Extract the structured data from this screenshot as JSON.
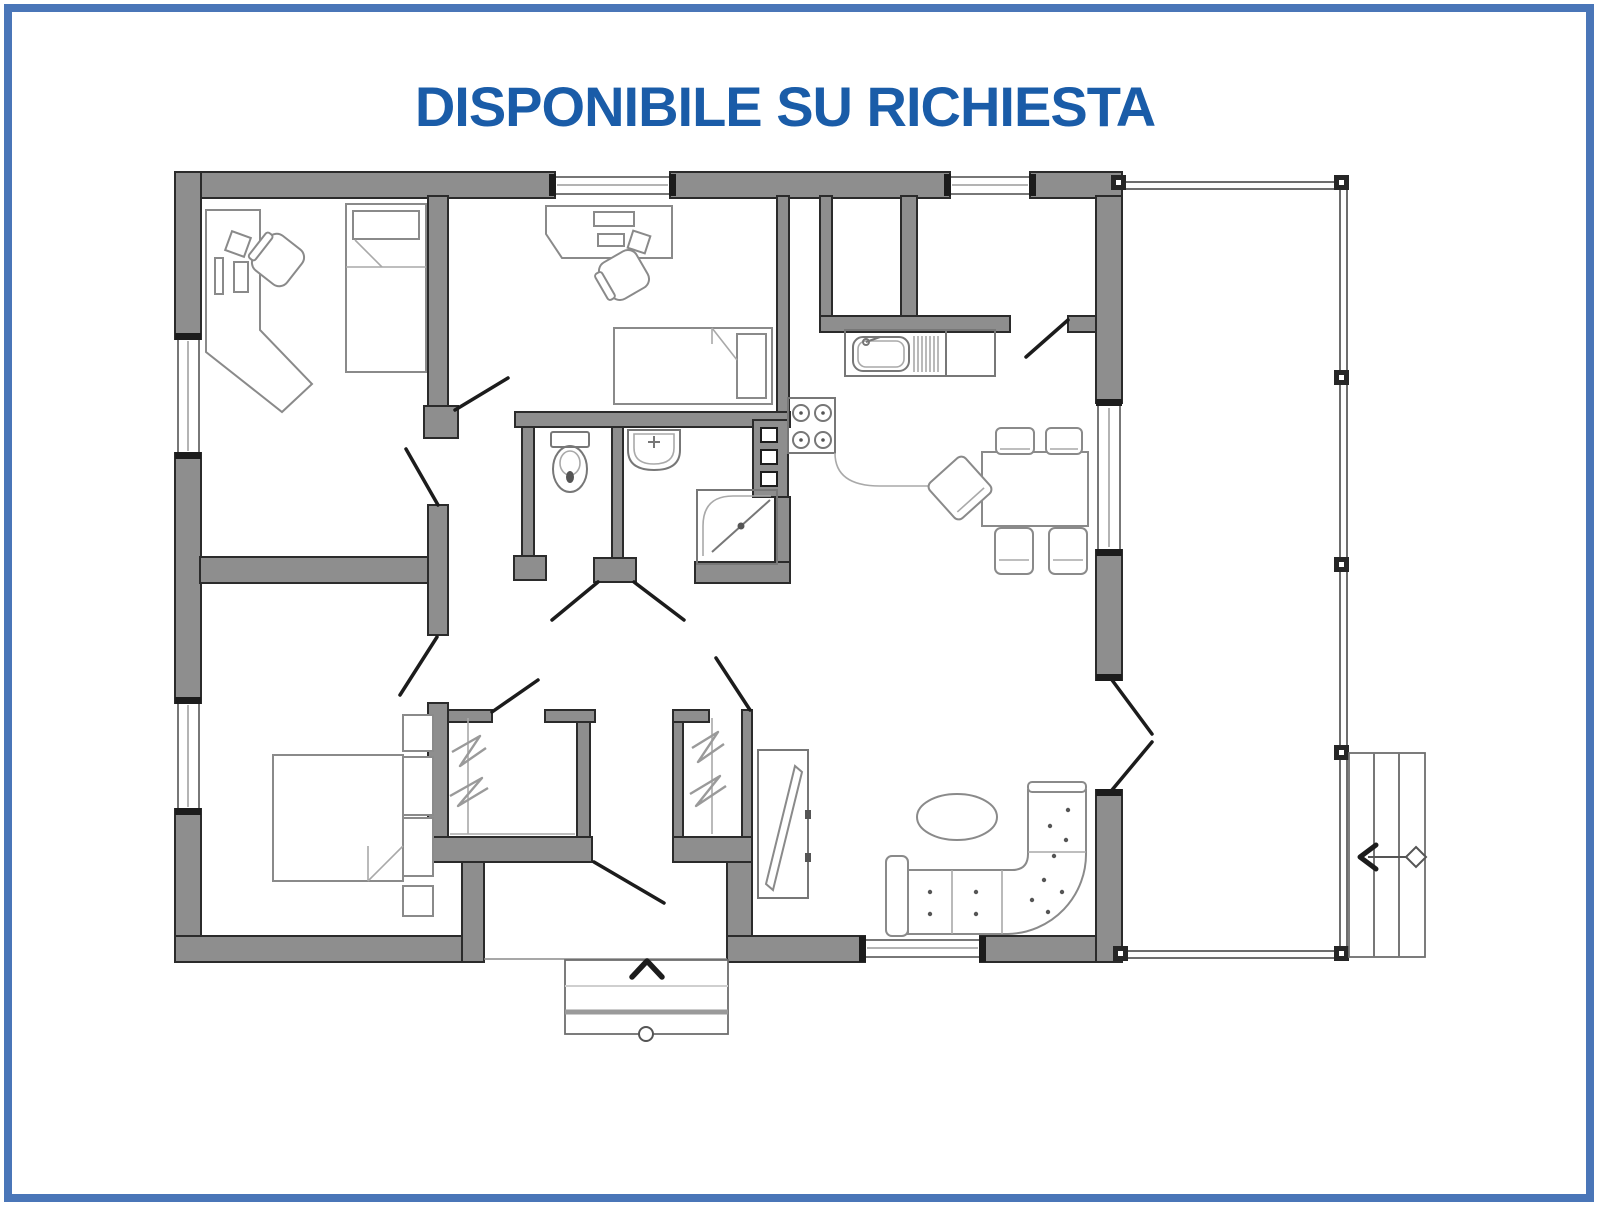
{
  "title": "DISPONIBILE SU RICHIESTA",
  "colors": {
    "frame-blue": "#4a76b8",
    "title-blue": "#1a5ca8",
    "wall-gray": "#8e8e8e",
    "wall-outline": "#2b2b2b",
    "furniture-gray": "#8a8a8a",
    "door-black": "#1c1c1c",
    "background": "#ffffff"
  },
  "plan": {
    "room_icons": [
      "bedroom-1",
      "bedroom-2",
      "bedroom-3",
      "wc",
      "bathroom",
      "kitchen",
      "dining-area",
      "living-room",
      "hall",
      "terrace"
    ],
    "furniture_icons": [
      "corner-desk",
      "office-chair",
      "single-bed",
      "desk",
      "toilet",
      "washbasin",
      "corner-shower",
      "utility-column",
      "kitchen-sink",
      "stove",
      "dining-table",
      "dining-chair",
      "sectional-sofa",
      "oval-coffee-table",
      "tv-panel",
      "double-bed",
      "nightstand",
      "wardrobe-hangers",
      "entry-steps",
      "terrace-stairs",
      "direction-arrow"
    ]
  }
}
